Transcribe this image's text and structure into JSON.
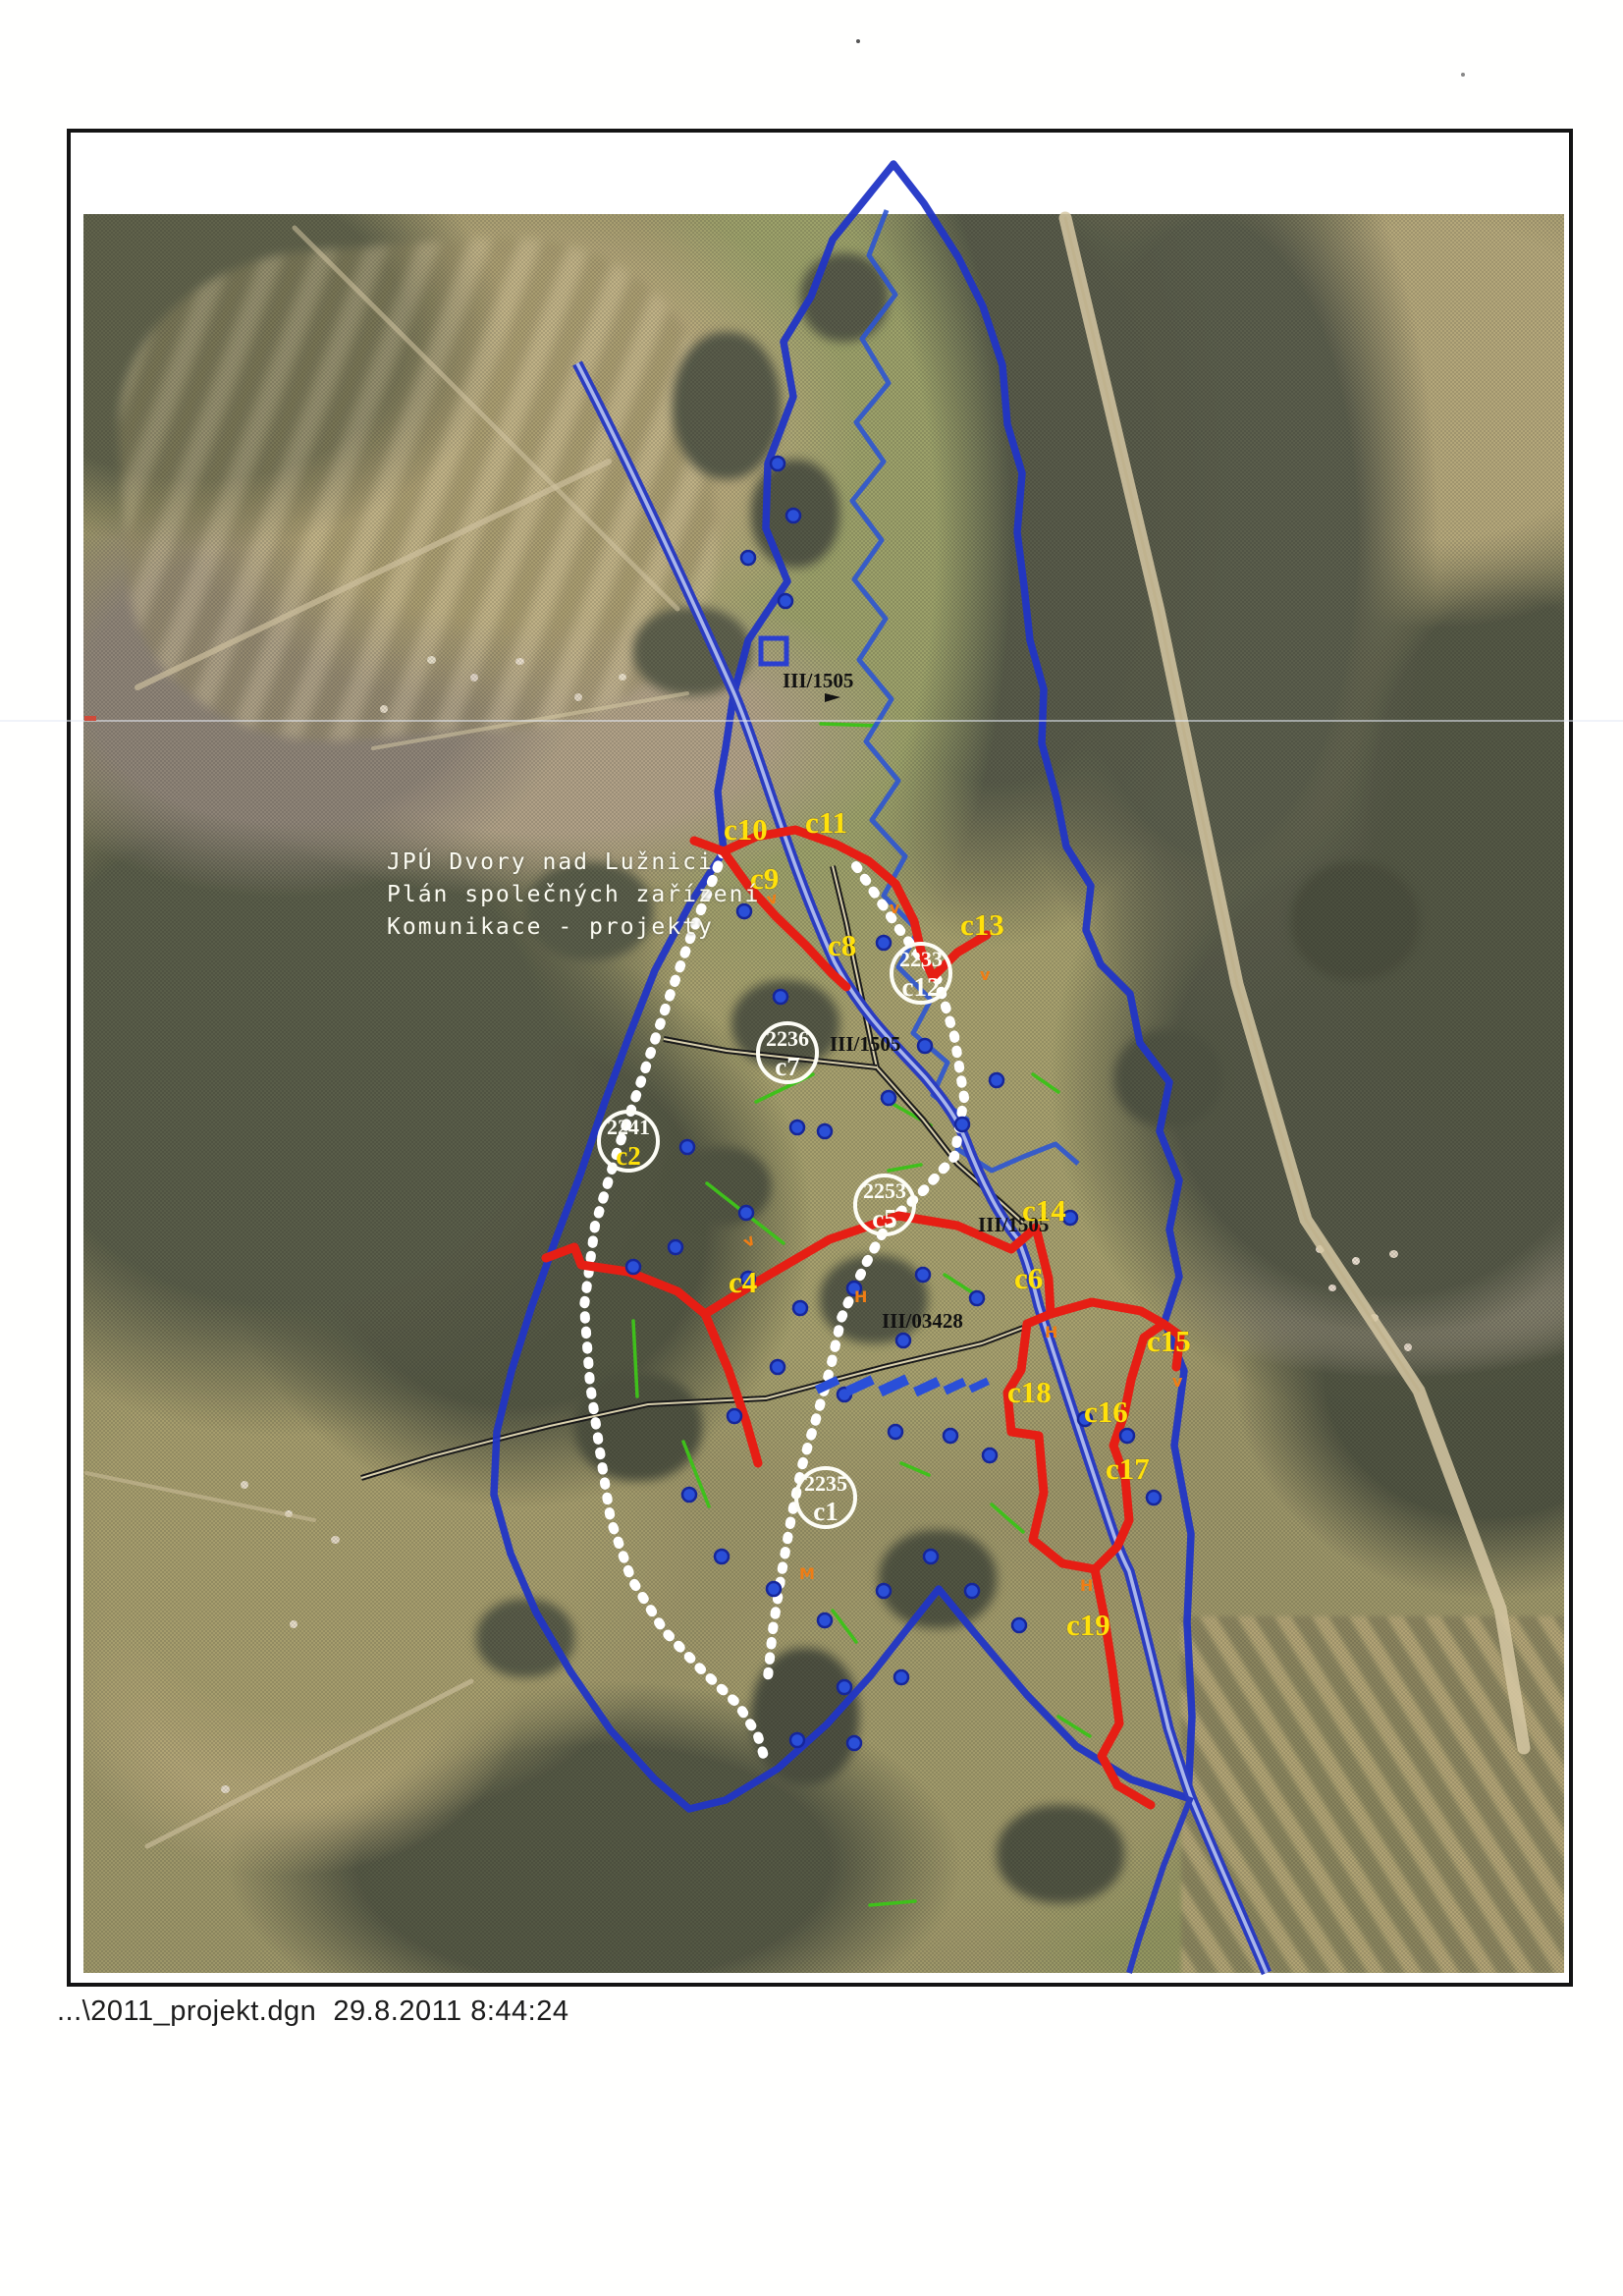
{
  "caption": {
    "text": "...\\2011_projekt.dgn  29.8.2011 8:44:24"
  },
  "map": {
    "title": {
      "line1": "JPÚ Dvory nad Lužnici",
      "line2": "Plán společných zařízení",
      "line3": "Komunikace  - projekty"
    },
    "road_labels": {
      "l1": "III/1505",
      "l2": "III/1505",
      "l3": "III/1505",
      "l4": "III/03428"
    },
    "routes": {
      "c4": "c4",
      "c6": "c6",
      "c8": "c8",
      "c9": "c9",
      "c10": "c10",
      "c11": "c11",
      "c13": "c13",
      "c14": "c14",
      "c15": "c15",
      "c16": "c16",
      "c17": "c17",
      "c18": "c18",
      "c19": "c19"
    },
    "circled": {
      "c1": {
        "num": "2235",
        "id": "c1"
      },
      "c2": {
        "num": "2241",
        "id": "c2"
      },
      "c5": {
        "num": "2253",
        "id": "c5"
      },
      "c7": {
        "num": "2236",
        "id": "c7"
      },
      "c12": {
        "num": "2233",
        "id": "c12"
      }
    },
    "markers": {
      "m1": "v",
      "m2": "v",
      "m3": "v",
      "m4": "H",
      "m5": "H",
      "m6": "M",
      "m7": "v",
      "m8": "v",
      "m9": "H"
    },
    "colors": {
      "route_red": "#e61e14",
      "route_white": "#ffffff",
      "boundary_blue": "#2135c6",
      "road_blue": "#2b3cc0",
      "river_blue": "#2e55d2",
      "label_yellow": "#ffe10a",
      "green": "#3fc01b",
      "orange": "#f07d14"
    }
  }
}
